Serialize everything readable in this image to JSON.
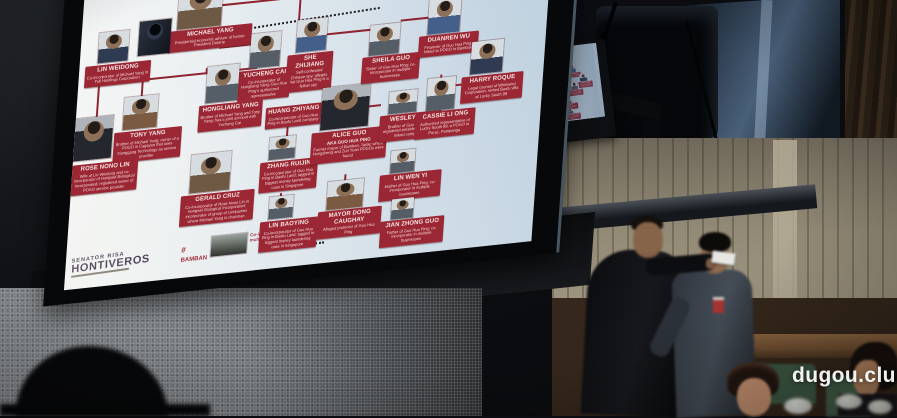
{
  "colors": {
    "box_red": "#9c2734",
    "line_red": "#8f2330",
    "slide_bg": "#dfe8ee",
    "wall_tan": "#948b77"
  },
  "watermark": "dugou.club",
  "mini_screen": {
    "caption": "Session Hall"
  },
  "slide": {
    "logo": {
      "line1": "SENATOR RISA",
      "line2": "HONTIVEROS"
    },
    "footnote": {
      "tag": "#",
      "name": "BAMBAN",
      "desc": "Co-incorporator of Guo Hua Ping in multiple businesses"
    },
    "nodes": [
      {
        "id": "michael-yang",
        "name": "MICHAEL YANG",
        "desc": "Presidential economic adviser of former President Duterte",
        "tone": "tan",
        "p": [
          96,
          51,
          44,
          40
        ],
        "l": [
          88,
          92,
          80
        ]
      },
      {
        "id": "unidentified-figure",
        "name": "",
        "desc": "",
        "tone": "mask",
        "p": [
          58,
          79,
          32,
          34
        ],
        "l": null
      },
      {
        "id": "lin-weidong",
        "name": "LIN WEIDONG",
        "desc": "Co-incorporator of Michael Yang in Full Holdings Corporation",
        "tone": "navy",
        "p": [
          18,
          86,
          30,
          30
        ],
        "l": [
          6,
          118,
          62
        ]
      },
      {
        "id": "she-zhijiang",
        "name": "SHE ZHIJIANG",
        "desc": "Self-confessed Chinese spy; alleges that Guo Hua Ping is a fellow spy",
        "tone": "blue",
        "p": [
          218,
          94,
          30,
          32
        ],
        "l": [
          210,
          128,
          42
        ]
      },
      {
        "id": "yucheng-cai",
        "name": "YUCHENG CAI",
        "desc": "Co-incorporator of Hongliang Yang; Guo Hua Ping's authorized representative",
        "tone": "gray",
        "p": [
          172,
          103,
          30,
          34
        ],
        "l": [
          162,
          139,
          48
        ]
      },
      {
        "id": "tony-yang",
        "name": "TONY YANG",
        "desc": "Brother of Michael Yang; owner of a POGO in Cagayan that uses Xionggang Technology as service provider",
        "tone": "warm",
        "p": [
          48,
          153,
          34,
          32
        ],
        "l": [
          40,
          187,
          64
        ]
      },
      {
        "id": "hongliang-yang",
        "name": "HONGLIANG YANG",
        "desc": "Brother of Michael Yang and Tony Yang; has a joint account with Yucheng Cai",
        "tone": "gray",
        "p": [
          130,
          131,
          32,
          36
        ],
        "l": [
          124,
          169,
          60
        ]
      },
      {
        "id": "rose-nono-lin",
        "name": "ROSE NONO LIN",
        "desc": "Wife of Lin Weidong and co-incorporator of Hongwei Biological Incorporated; registered owner of POGO service provider",
        "tone": "dark",
        "p": [
          0,
          169,
          38,
          42
        ],
        "l": [
          0,
          215,
          62
        ]
      },
      {
        "id": "gerald-cruz",
        "name": "GERALD CRUZ",
        "desc": "Co-incorporator of Rose Nono Lin in Hongwei Biological Incorporated; incorporator of group of companies where Michael Yang is chairman",
        "tone": "tan",
        "p": [
          120,
          217,
          40,
          38
        ],
        "l": [
          112,
          257,
          70
        ]
      },
      {
        "id": "huang-zhiyang",
        "name": "HUANG ZHIYANG",
        "desc": "Co-incorporator of Guo Hua Ping in Baofu Land company",
        "tone": "gray",
        "p": null,
        "l": [
          192,
          178,
          52
        ]
      },
      {
        "id": "zhang-ruijin",
        "name": "ZHANG RUIJIN",
        "desc": "Co-incorporator of Guo Hua Ping in Baofu Land; tagged in biggest money laundering case in Singapore",
        "tone": "gray",
        "p": [
          198,
          208,
          26,
          22
        ],
        "l": [
          190,
          232,
          54
        ]
      },
      {
        "id": "lin-baoying",
        "name": "LIN BAOYING",
        "desc": "Co-incorporator of Guo Hua Ping in Baofu Land; tagged in biggest money laundering case in Singapore",
        "tone": "gray",
        "p": [
          202,
          267,
          24,
          22
        ],
        "l": [
          194,
          291,
          54
        ]
      },
      {
        "id": "alice-guo",
        "name": "ALICE GUO",
        "sub": "AKA GUO HUA PING",
        "desc": "Former mayor of Bamban, Tarlac where Hongsheng and Zun Yuan POGOs were found",
        "tone": "dark",
        "p": [
          248,
          164,
          48,
          42
        ],
        "l": [
          240,
          208,
          72
        ]
      },
      {
        "id": "sheila-guo",
        "name": "SHEILA GUO",
        "desc": "'Sister' of Guo Hua Ping; co-incorporator in multiple businesses",
        "tone": "gray",
        "p": [
          292,
          107,
          30,
          30
        ],
        "l": [
          286,
          138,
          54
        ]
      },
      {
        "id": "wesley-guo",
        "name": "WESLEY GUO",
        "desc": "Brother of Guo Hua Ping; registered president of POGO-linked companies",
        "tone": "gray",
        "p": [
          316,
          175,
          28,
          22
        ],
        "l": [
          308,
          198,
          58
        ]
      },
      {
        "id": "lin-wen-yi",
        "name": "LIN WEN YI",
        "desc": "Mother of Guo Hua Ping; co-incorporator in multiple businesses",
        "tone": "gray",
        "p": [
          322,
          234,
          24,
          22
        ],
        "l": [
          312,
          257,
          58
        ]
      },
      {
        "id": "jian-zhong-guo",
        "name": "JIAN ZHONG GUO",
        "desc": "Father of Guo Hua Ping; co-incorporator in multiple businesses",
        "tone": "gray",
        "p": [
          326,
          282,
          22,
          20
        ],
        "l": [
          316,
          303,
          60
        ]
      },
      {
        "id": "mayor-dong-caughay",
        "name": "MAYOR DONG CAUGHAY",
        "desc": "Alleged protector of Guo Hua Ping",
        "tone": "warm",
        "p": [
          260,
          258,
          36,
          28
        ],
        "l": [
          252,
          287,
          60
        ]
      },
      {
        "id": "duanren-wu",
        "name": "DUANREN WU",
        "desc": "Financier of Guo Hua Ping; linked to POGO in Bamban",
        "tone": "blue",
        "p": [
          350,
          86,
          32,
          36
        ],
        "l": [
          342,
          123,
          56
        ]
      },
      {
        "id": "cassie-li-ong",
        "name": "CASSIE LI ONG",
        "desc": "Authorized representative of Lucky South 99, a POGO in Porac, Pampanga",
        "tone": "gray",
        "p": [
          354,
          166,
          28,
          32
        ],
        "l": [
          344,
          199,
          56
        ]
      },
      {
        "id": "harry-roque",
        "name": "HARRY ROQUE",
        "desc": "Legal counsel of Whirlwind Corporation; rented Baofu villa at Lucky South 99",
        "tone": "navy",
        "p": [
          396,
          134,
          32,
          32
        ],
        "l": [
          388,
          168,
          58
        ]
      }
    ],
    "connectors": [
      [
        128,
        132,
        2,
        6
      ],
      [
        20,
        136,
        160,
        2
      ],
      [
        20,
        138,
        2,
        31
      ],
      [
        64,
        138,
        2,
        15
      ],
      [
        146,
        138,
        2,
        29
      ],
      [
        140,
        112,
        32,
        2
      ],
      [
        140,
        70,
        78,
        2
      ],
      [
        218,
        72,
        2,
        22
      ],
      [
        214,
        182,
        2,
        26
      ],
      [
        244,
        190,
        8,
        2
      ],
      [
        248,
        110,
        44,
        2
      ],
      [
        322,
        104,
        28,
        2
      ],
      [
        296,
        186,
        12,
        2
      ],
      [
        276,
        252,
        2,
        6
      ],
      [
        382,
        174,
        14,
        2
      ],
      [
        212,
        264,
        2,
        4
      ],
      [
        366,
        163,
        2,
        4
      ]
    ],
    "dotted": [
      [
        170,
        96,
        130,
        -3
      ],
      [
        216,
        318,
        44,
        -2
      ]
    ]
  }
}
